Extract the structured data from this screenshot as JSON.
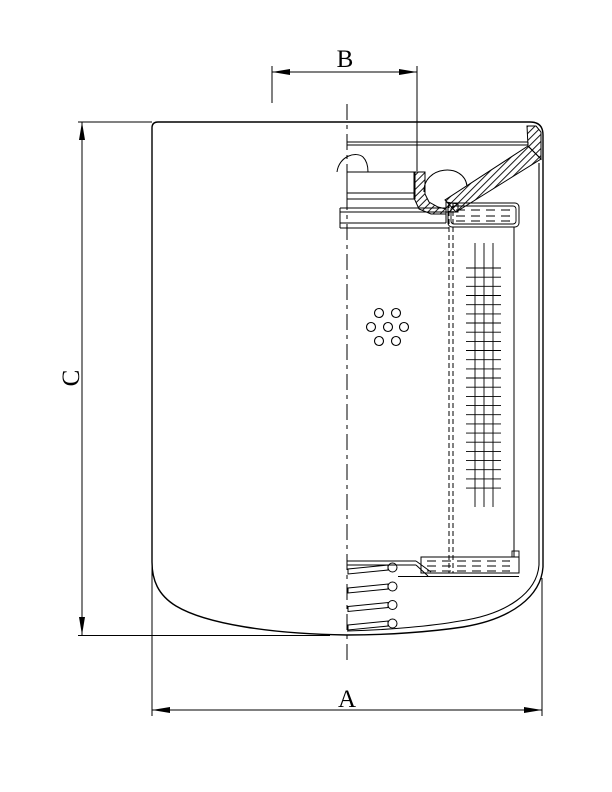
{
  "drawing": {
    "kind": "cross-section-engineering-drawing",
    "colors": {
      "line": "#000000",
      "background": "#ffffff"
    },
    "dimensions": {
      "top": {
        "label": "B"
      },
      "left": {
        "label": "C"
      },
      "bottom": {
        "label": "A"
      }
    }
  }
}
